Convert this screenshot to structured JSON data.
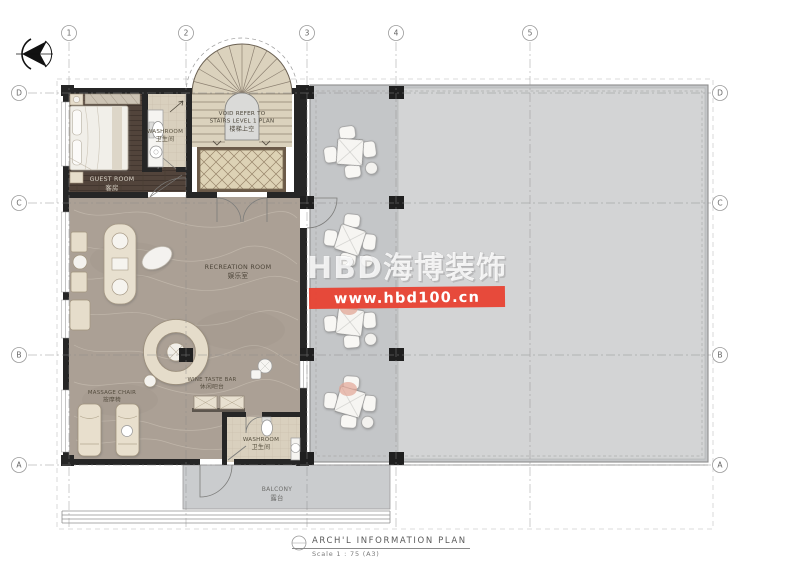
{
  "grid": {
    "columns": [
      {
        "label": "1"
      },
      {
        "label": "2"
      },
      {
        "label": "3"
      },
      {
        "label": "4"
      },
      {
        "label": "5"
      }
    ],
    "rows": [
      {
        "label": "D"
      },
      {
        "label": "C"
      },
      {
        "label": "B"
      },
      {
        "label": "A"
      }
    ]
  },
  "rooms": {
    "guest_room": {
      "en": "GUEST ROOM",
      "cn": "客房"
    },
    "washroom_top": {
      "en": "WASHROOM",
      "cn": "卫生间"
    },
    "recreation": {
      "en": "RECREATION ROOM",
      "cn": "娱乐室"
    },
    "massage": {
      "en": "MASSAGE CHAIR",
      "cn": "按摩椅"
    },
    "mini_bar": {
      "en": "WINE TASTE BAR",
      "cn": "休闲吧台"
    },
    "washroom_bottom": {
      "en": "WASHROOM",
      "cn": "卫生间"
    },
    "balcony": {
      "en": "BALCONY",
      "cn": "露台"
    }
  },
  "stairs": {
    "line1": "VOID REFER TO",
    "line2": "STAIRS LEVEL 1 PLAN",
    "cn": "楼梯上空"
  },
  "watermark": {
    "brand": "HBD海博装饰",
    "url": "www.hbd100.cn",
    "red": "#e8402f"
  },
  "titleblock": {
    "title": "ARCH'L  INFORMATION  PLAN",
    "scale": "Scale  1 : 75  (A3)"
  },
  "icons": {
    "north_arrow": "left-pointing compass"
  },
  "colors": {
    "wall": "#262626",
    "wood_floor": "#52443b",
    "marble_floor": "#aba095",
    "tile_floor": "#d9d0be",
    "stair_floor": "#dbd2bd",
    "terrace": "#c4c6c8",
    "terrace_light": "#d3d4d5",
    "rug": "#ddd2b5"
  }
}
